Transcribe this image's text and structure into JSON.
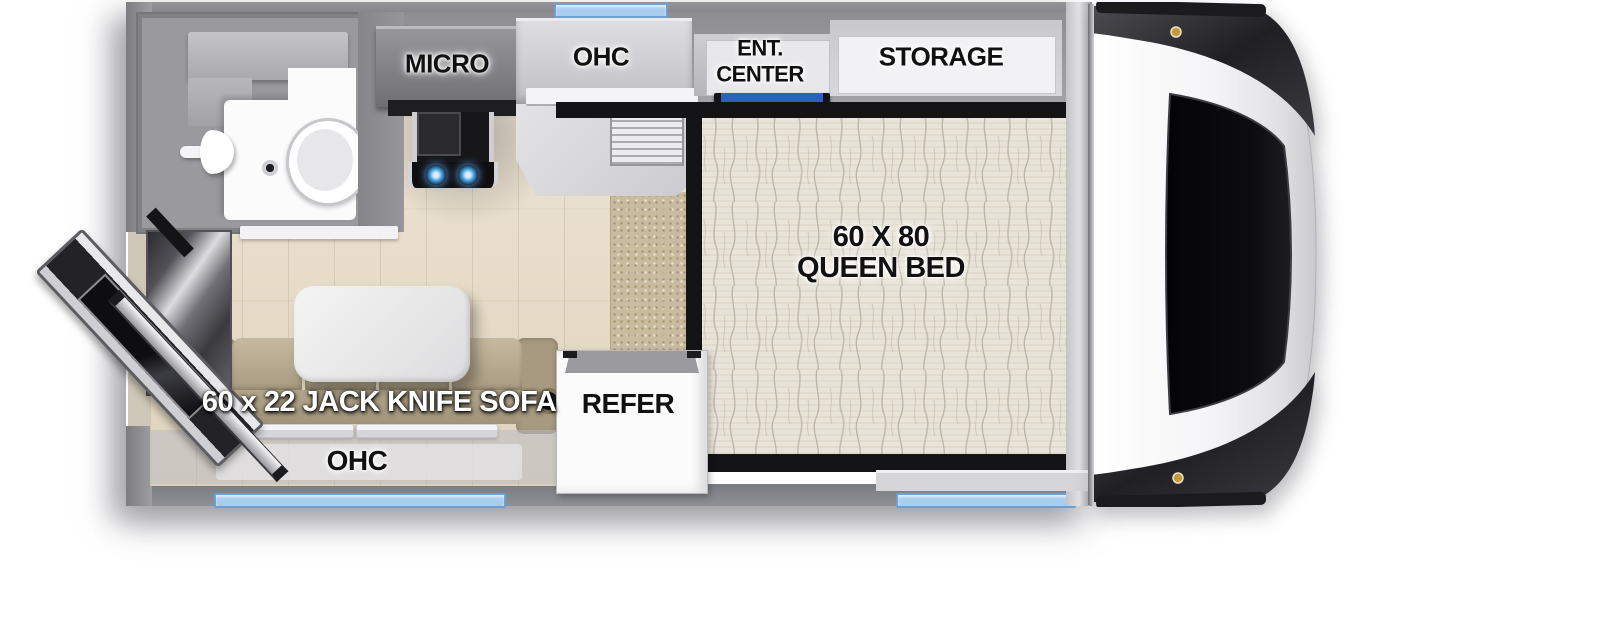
{
  "floorplan": {
    "title": "Truck camper floor plan",
    "labels": {
      "micro": "MICRO",
      "ohc_top": "OHC",
      "ent_center_line1": "ENT.",
      "ent_center_line2": "CENTER",
      "storage": "STORAGE",
      "bed_line1": "60 X 80",
      "bed_line2": "QUEEN BED",
      "sofa": "60 x 22 JACK KNIFE SOFA",
      "ohc_bottom": "OHC",
      "refer": "REFER"
    },
    "colors": {
      "wall": "#8d8d91",
      "window_blue": "#a9cdec",
      "tv_blue": "#2f5fc2",
      "sofa_tan": "#b5a88e",
      "floor_wood": "#e7decd",
      "carpet": "#c9bb9f",
      "mattress": "#e9e4d9",
      "burner_blue": "#4aa8e8"
    }
  }
}
